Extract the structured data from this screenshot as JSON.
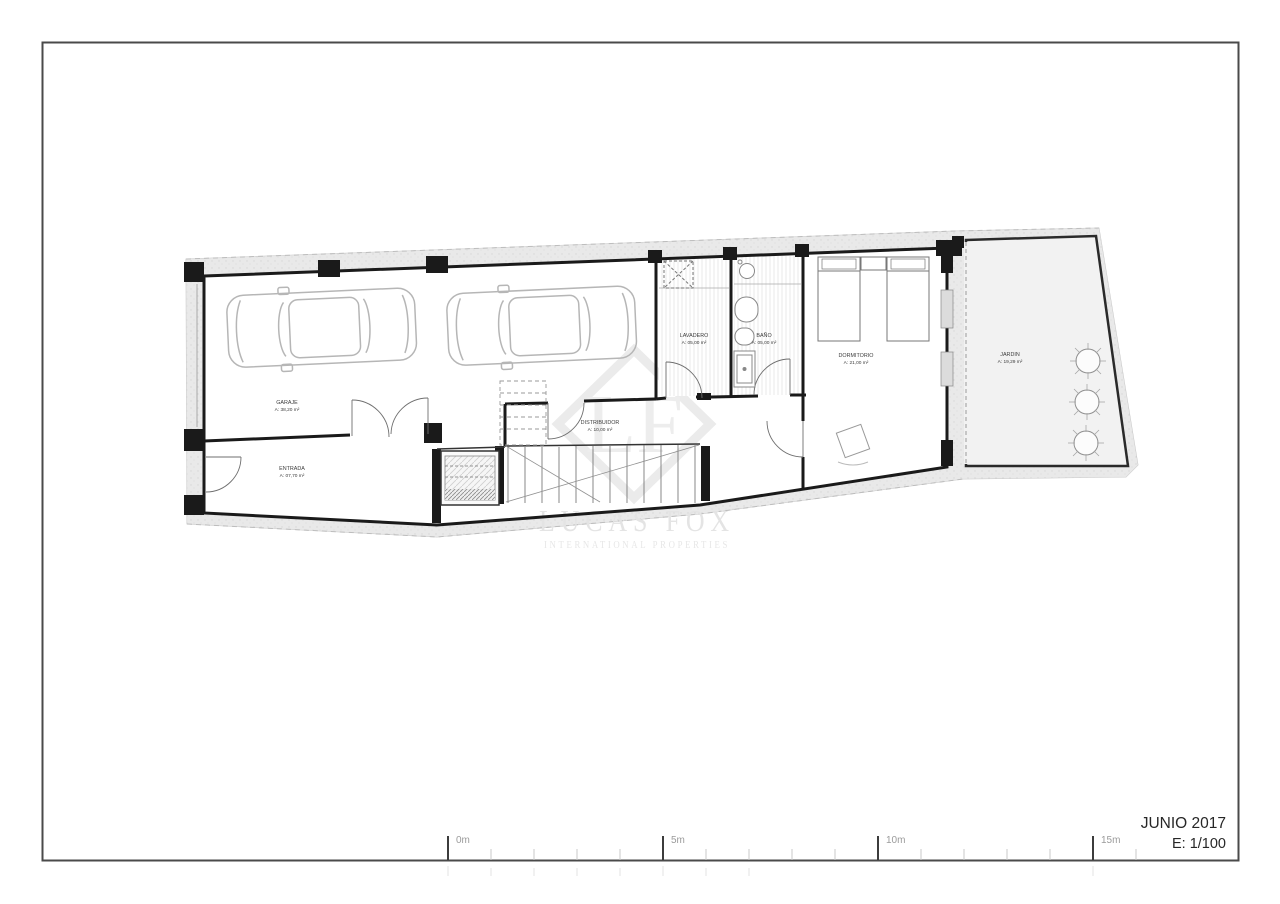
{
  "titleblock": {
    "date": "JUNIO 2017",
    "scale": "E: 1/100"
  },
  "scalebar": {
    "labels": [
      "0m",
      "5m",
      "10m",
      "15m"
    ]
  },
  "watermark": {
    "logo_text": "LF",
    "brand": "LUCAS FOX",
    "tagline": "INTERNATIONAL PROPERTIES"
  },
  "rooms": [
    {
      "name": "GARAJE",
      "area": "A: 38,20 m²"
    },
    {
      "name": "ENTRADA",
      "area": "A: 07,70 m²"
    },
    {
      "name": "DISTRIBUIDOR",
      "area": "A: 10,00 m²"
    },
    {
      "name": "LAVADERO",
      "area": "A: 05,00 m²"
    },
    {
      "name": "BAÑO",
      "area": "A: 05,00 m²"
    },
    {
      "name": "DORMITORIO",
      "area": "A: 21,00 m²"
    },
    {
      "name": "JARDIN",
      "area": "A: 19,29 m²"
    }
  ],
  "icons": {
    "car": "car-plan-icon",
    "tree": "tree-plan-icon",
    "washer": "washing-machine-icon",
    "sink": "sink-icon",
    "toilet": "toilet-icon",
    "bidet": "bidet-icon",
    "shower": "shower-tray-icon",
    "bed": "bed-icon",
    "door": "door-swing-icon"
  },
  "colors": {
    "wall": "#1a1a1a",
    "site_band": "#e9e9e9",
    "watermark": "#e6e6e6",
    "paper": "#ffffff"
  }
}
